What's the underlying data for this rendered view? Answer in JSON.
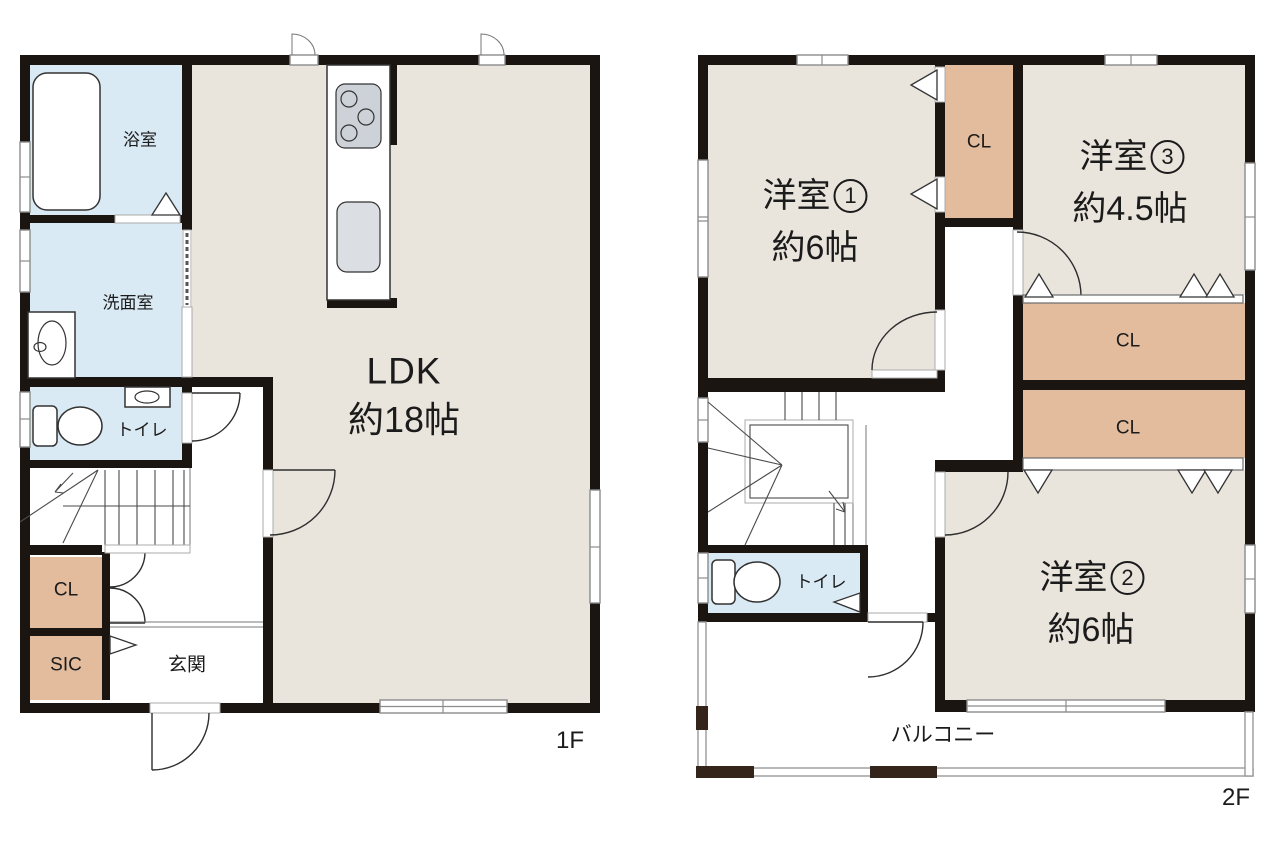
{
  "floor1": {
    "floor_label": "1F",
    "rooms": {
      "bath": "浴室",
      "washroom": "洗面室",
      "toilet": "トイレ",
      "closet": "CL",
      "shoe_closet": "SIC",
      "entrance": "玄関",
      "ldk_name": "LDK",
      "ldk_size": "約18帖"
    }
  },
  "floor2": {
    "floor_label": "2F",
    "rooms": {
      "bedroom1_name": "洋室",
      "bedroom1_num": "1",
      "bedroom1_size": "約6帖",
      "bedroom1_closet": "CL",
      "bedroom3_name": "洋室",
      "bedroom3_num": "3",
      "bedroom3_size": "約4.5帖",
      "closet_upper": "CL",
      "closet_lower": "CL",
      "toilet": "トイレ",
      "bedroom2_name": "洋室",
      "bedroom2_num": "2",
      "bedroom2_size": "約6帖",
      "balcony": "バルコニー"
    }
  },
  "colors": {
    "room_floor": "#EAE5DC",
    "wet_area": "#D9EAF4",
    "closet": "#E3BC9D",
    "wall": "#1B1512",
    "balcony_post": "#35241A"
  }
}
